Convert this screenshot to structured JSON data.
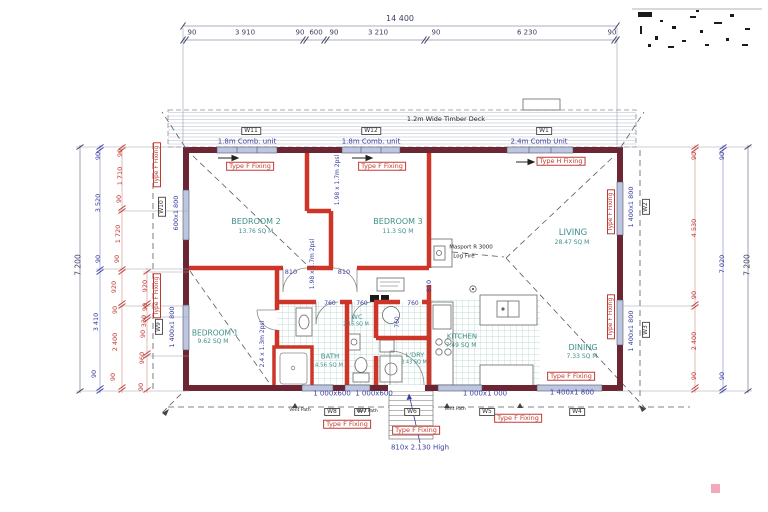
{
  "colors": {
    "exterior_wall": "#6B2533",
    "interior_wall": "#CC3527",
    "window_fill": "#BDC5E4",
    "dim_blue": "#3a3f9e",
    "dim_red": "#c23b33",
    "room_text": "#3e8f8a",
    "tile_line": "#aed2ca"
  },
  "annotations": {
    "top_dimension_chain": [
      {
        "n": "overall-width-dim",
        "t": "14 400",
        "x": 400,
        "y": 19,
        "c": "dkb",
        "s": 8
      },
      {
        "n": "seg-dim",
        "t": "90",
        "x": 192,
        "y": 33,
        "c": "dkb"
      },
      {
        "n": "seg-dim",
        "t": "3 910",
        "x": 245,
        "y": 33,
        "c": "dkb"
      },
      {
        "n": "seg-dim",
        "t": "90",
        "x": 300,
        "y": 33,
        "c": "dkb"
      },
      {
        "n": "seg-dim",
        "t": "600",
        "x": 316,
        "y": 33,
        "c": "dkb"
      },
      {
        "n": "seg-dim",
        "t": "90",
        "x": 334,
        "y": 33,
        "c": "dkb"
      },
      {
        "n": "seg-dim",
        "t": "3 210",
        "x": 378,
        "y": 33,
        "c": "dkb"
      },
      {
        "n": "seg-dim",
        "t": "90",
        "x": 436,
        "y": 33,
        "c": "dkb"
      },
      {
        "n": "seg-dim",
        "t": "6 230",
        "x": 527,
        "y": 33,
        "c": "dkb"
      },
      {
        "n": "seg-dim",
        "t": "90",
        "x": 612,
        "y": 33,
        "c": "dkb"
      }
    ],
    "deck": [
      {
        "n": "deck-label",
        "t": "1.2m Wide Timber Deck",
        "x": 446,
        "y": 119,
        "c": "dark",
        "s": 6.5
      },
      {
        "n": "window-tag-w11",
        "t": "W11",
        "x": 251,
        "y": 131,
        "b": "tag",
        "s": 6
      },
      {
        "n": "window-tag-w12",
        "t": "W12",
        "x": 371,
        "y": 131,
        "b": "tag",
        "s": 6
      },
      {
        "n": "window-tag-w1",
        "t": "W1",
        "x": 544,
        "y": 131,
        "b": "tag",
        "s": 6
      },
      {
        "n": "comb-unit-label",
        "t": "1.8m Comb. unit",
        "x": 247,
        "y": 142,
        "c": "blue",
        "s": 7
      },
      {
        "n": "comb-unit-label",
        "t": "1.8m Comb. unit",
        "x": 371,
        "y": 142,
        "c": "blue",
        "s": 7
      },
      {
        "n": "comb-unit-label",
        "t": "2.4m Comb Unit",
        "x": 539,
        "y": 142,
        "c": "blue",
        "s": 7
      }
    ],
    "fixing_labels": [
      {
        "n": "fixing-label",
        "t": "Type F Fixing",
        "x": 250,
        "y": 166,
        "b": "fix",
        "s": 6.5
      },
      {
        "n": "fixing-label",
        "t": "Type F Fixing",
        "x": 382,
        "y": 166,
        "b": "fix",
        "s": 6.5
      },
      {
        "n": "fixing-label",
        "t": "Type H Fixing",
        "x": 561,
        "y": 161,
        "b": "fix",
        "s": 6.5
      },
      {
        "n": "fixing-label",
        "t": "Type F Fixing",
        "x": 611,
        "y": 212,
        "b": "fix",
        "r": 1,
        "s": 6
      },
      {
        "n": "fixing-label",
        "t": "Type F Fixing",
        "x": 611,
        "y": 317,
        "b": "fix",
        "r": 1,
        "s": 6
      },
      {
        "n": "fixing-label",
        "t": "Type F Fixing",
        "x": 157,
        "y": 165,
        "b": "fix",
        "r": 1,
        "s": 6
      },
      {
        "n": "fixing-label",
        "t": "Type F Fixing",
        "x": 157,
        "y": 296,
        "b": "fix",
        "r": 1,
        "s": 6
      },
      {
        "n": "fixing-label",
        "t": "Type F Fixing",
        "x": 571,
        "y": 376,
        "b": "fix",
        "s": 6.5
      },
      {
        "n": "fixing-label",
        "t": "Type F Fixing",
        "x": 347,
        "y": 424,
        "b": "fix",
        "s": 6.5
      },
      {
        "n": "fixing-label",
        "t": "Type F Fixing",
        "x": 416,
        "y": 430,
        "b": "fix",
        "s": 6.5
      },
      {
        "n": "fixing-label",
        "t": "Type F Fixing",
        "x": 518,
        "y": 418,
        "b": "fix",
        "s": 6.5
      }
    ],
    "rooms": [
      {
        "n": "room-name-bedroom2",
        "t": "BEDROOM 2",
        "x": 256,
        "y": 222,
        "c": "teal",
        "s": 8
      },
      {
        "n": "room-area-bedroom2",
        "t": "13.76 SQ M",
        "x": 256,
        "y": 232,
        "c": "teal",
        "s": 6
      },
      {
        "n": "room-name-bedroom3",
        "t": "BEDROOM 3",
        "x": 398,
        "y": 222,
        "c": "teal",
        "s": 8
      },
      {
        "n": "room-area-bedroom3",
        "t": "11.3 SQ M",
        "x": 398,
        "y": 232,
        "c": "teal",
        "s": 6
      },
      {
        "n": "room-name-living",
        "t": "LIVING",
        "x": 573,
        "y": 233,
        "c": "teal",
        "s": 8.5
      },
      {
        "n": "room-area-living",
        "t": "28.47 SQ M",
        "x": 572,
        "y": 243,
        "c": "teal",
        "s": 6
      },
      {
        "n": "room-name-bedroom1",
        "t": "BEDROOM 1",
        "x": 215,
        "y": 333,
        "c": "teal",
        "s": 7.5
      },
      {
        "n": "room-area-bedroom1",
        "t": "9.62 SQ M",
        "x": 213,
        "y": 342,
        "c": "teal",
        "s": 6
      },
      {
        "n": "room-name-bath",
        "t": "BATH",
        "x": 330,
        "y": 357,
        "c": "teal",
        "s": 7
      },
      {
        "n": "room-area-bath",
        "t": "4.56 SQ M",
        "x": 329,
        "y": 366,
        "c": "teal",
        "s": 5.5
      },
      {
        "n": "room-name-wc",
        "t": "WC",
        "x": 357,
        "y": 317,
        "c": "teal",
        "s": 6.5
      },
      {
        "n": "room-area-wc",
        "t": "2.16 SQ M",
        "x": 356,
        "y": 325,
        "c": "teal",
        "s": 5
      },
      {
        "n": "room-name-ldry",
        "t": "L'DRY",
        "x": 415,
        "y": 355,
        "c": "teal",
        "s": 6.5
      },
      {
        "n": "room-area-ldry",
        "t": "3.43 SQ M",
        "x": 414,
        "y": 363,
        "c": "teal",
        "s": 5
      },
      {
        "n": "room-name-kitchen",
        "t": "KITCHEN",
        "x": 462,
        "y": 337,
        "c": "teal",
        "s": 7
      },
      {
        "n": "room-area-kitchen",
        "t": "7.49 SQ M",
        "x": 461,
        "y": 346,
        "c": "teal",
        "s": 6
      },
      {
        "n": "room-name-dining",
        "t": "DINING",
        "x": 583,
        "y": 348,
        "c": "teal",
        "s": 8
      },
      {
        "n": "room-area-dining",
        "t": "7.33 SQ M",
        "x": 582,
        "y": 357,
        "c": "teal",
        "s": 6
      }
    ],
    "fireplace_note": [
      {
        "n": "fireplace-note-line1",
        "t": "Masport R 3000",
        "x": 471,
        "y": 248,
        "c": "dark",
        "s": 5.5
      },
      {
        "n": "fireplace-note-line2",
        "t": "Log Fire",
        "x": 464,
        "y": 257,
        "c": "dark",
        "s": 5.5
      }
    ],
    "opening_dims": [
      {
        "n": "window-dim-w10",
        "t": "600x1 800",
        "x": 176,
        "y": 213,
        "c": "blue",
        "r": 1,
        "s": 6.5
      },
      {
        "n": "window-dim-w9",
        "t": "1 400x1 800",
        "x": 172,
        "y": 327,
        "c": "blue",
        "r": 1,
        "s": 6.5
      },
      {
        "n": "window-dim-w2",
        "t": "1 400x1 800",
        "x": 631,
        "y": 207,
        "c": "blue",
        "r": 1,
        "s": 6.5
      },
      {
        "n": "window-dim-w3",
        "t": "1 400x1 800",
        "x": 631,
        "y": 331,
        "c": "blue",
        "r": 1,
        "s": 6.5
      },
      {
        "n": "window-tag-w2",
        "t": "W2",
        "x": 646,
        "y": 207,
        "b": "tag",
        "r": 1,
        "s": 6
      },
      {
        "n": "window-tag-w3",
        "t": "W3",
        "x": 646,
        "y": 330,
        "b": "tag",
        "r": 1,
        "s": 6
      },
      {
        "n": "window-tag-w10",
        "t": "W10",
        "x": 162,
        "y": 207,
        "b": "tag",
        "r": 1,
        "s": 6
      },
      {
        "n": "window-tag-w9",
        "t": "W9",
        "x": 159,
        "y": 327,
        "b": "tag",
        "r": 1,
        "s": 6
      },
      {
        "n": "slider-dim",
        "t": "1.98 x 1.7m 2psl",
        "x": 338,
        "y": 180,
        "c": "blue",
        "r": 1,
        "s": 6
      },
      {
        "n": "slider-dim",
        "t": "1.98 x 1.7m 2psl",
        "x": 313,
        "y": 264,
        "c": "blue",
        "r": 1,
        "s": 6
      },
      {
        "n": "slider-dim",
        "t": "2.4 x 1.3m 2psl",
        "x": 263,
        "y": 344,
        "c": "blue",
        "r": 1,
        "s": 6
      },
      {
        "n": "door-dim",
        "t": "810",
        "x": 291,
        "y": 272,
        "c": "blue",
        "s": 6.5
      },
      {
        "n": "door-dim",
        "t": "810",
        "x": 344,
        "y": 272,
        "c": "blue",
        "s": 6.5
      },
      {
        "n": "door-dim",
        "t": "810",
        "x": 429,
        "y": 286,
        "c": "blue",
        "r": 1,
        "s": 6.5
      },
      {
        "n": "door-dim",
        "t": "760",
        "x": 330,
        "y": 304,
        "c": "blue",
        "s": 6
      },
      {
        "n": "door-dim",
        "t": "760",
        "x": 362,
        "y": 304,
        "c": "blue",
        "s": 6
      },
      {
        "n": "door-dim",
        "t": "760",
        "x": 413,
        "y": 304,
        "c": "blue",
        "s": 6
      },
      {
        "n": "door-dim",
        "t": "760",
        "x": 398,
        "y": 322,
        "c": "blue",
        "r": 1,
        "s": 6
      }
    ],
    "bottom_dims": [
      {
        "n": "window-dim-w8",
        "t": "1 000x600",
        "x": 332,
        "y": 394,
        "c": "blue",
        "s": 7
      },
      {
        "n": "window-dim-w7",
        "t": "1 000x600",
        "x": 374,
        "y": 394,
        "c": "blue",
        "s": 7
      },
      {
        "n": "window-dim-w5",
        "t": "1 000x1 000",
        "x": 485,
        "y": 394,
        "c": "blue",
        "s": 7
      },
      {
        "n": "window-dim-w4",
        "t": "1 400x1 800",
        "x": 572,
        "y": 393,
        "c": "blue",
        "s": 7
      },
      {
        "n": "door-height-note",
        "t": "810x 2.130 High",
        "x": 420,
        "y": 448,
        "c": "blue",
        "s": 7
      },
      {
        "n": "window-tag-w8",
        "t": "W8",
        "x": 332,
        "y": 412,
        "b": "tag",
        "s": 6
      },
      {
        "n": "window-tag-w7",
        "t": "W7",
        "x": 362,
        "y": 412,
        "b": "tag",
        "s": 6
      },
      {
        "n": "window-tag-w6",
        "t": "W6",
        "x": 412,
        "y": 412,
        "b": "tag",
        "s": 6
      },
      {
        "n": "window-tag-w5",
        "t": "W5",
        "x": 487,
        "y": 412,
        "b": "tag",
        "s": 6
      },
      {
        "n": "window-tag-w4",
        "t": "W4",
        "x": 577,
        "y": 412,
        "b": "tag",
        "s": 6
      },
      {
        "n": "vent-path-label",
        "t": "Vent Path",
        "x": 300,
        "y": 411,
        "c": "dark",
        "s": 4.5
      },
      {
        "n": "vent-path-label",
        "t": "Vent Path",
        "x": 367,
        "y": 412,
        "c": "dark",
        "s": 4.5
      },
      {
        "n": "vent-path-label",
        "t": "Vent Path",
        "x": 455,
        "y": 410,
        "c": "dark",
        "s": 4.5
      }
    ],
    "left_dims": [
      {
        "n": "left-overall-dim",
        "t": "7 200",
        "x": 78,
        "y": 265,
        "c": "dkb",
        "r": 1,
        "s": 7.5
      },
      {
        "n": "left-dim",
        "t": "90",
        "x": 98,
        "y": 156,
        "c": "blue",
        "r": 1,
        "s": 6.5
      },
      {
        "n": "left-dim",
        "t": "3 520",
        "x": 98,
        "y": 203,
        "c": "blue",
        "r": 1,
        "s": 6.5
      },
      {
        "n": "left-dim",
        "t": "90",
        "x": 98,
        "y": 259,
        "c": "blue",
        "r": 1,
        "s": 6.5
      },
      {
        "n": "left-dim",
        "t": "3 410",
        "x": 96,
        "y": 322,
        "c": "blue",
        "r": 1,
        "s": 6.5
      },
      {
        "n": "left-dim",
        "t": "90",
        "x": 94,
        "y": 374,
        "c": "blue",
        "r": 1,
        "s": 6.5
      },
      {
        "n": "left-dim",
        "t": "90",
        "x": 120,
        "y": 153,
        "c": "red",
        "r": 1,
        "s": 6.5
      },
      {
        "n": "left-dim",
        "t": "1 710",
        "x": 120,
        "y": 176,
        "c": "red",
        "r": 1,
        "s": 6.5
      },
      {
        "n": "left-dim",
        "t": "90",
        "x": 119,
        "y": 199,
        "c": "red",
        "r": 1,
        "s": 6.5
      },
      {
        "n": "left-dim",
        "t": "1 720",
        "x": 118,
        "y": 234,
        "c": "red",
        "r": 1,
        "s": 6.5
      },
      {
        "n": "left-dim",
        "t": "90",
        "x": 117,
        "y": 259,
        "c": "red",
        "r": 1,
        "s": 6.5
      },
      {
        "n": "left-dim",
        "t": "920",
        "x": 114,
        "y": 287,
        "c": "red",
        "r": 1,
        "s": 6.5
      },
      {
        "n": "left-dim",
        "t": "90",
        "x": 115,
        "y": 310,
        "c": "red",
        "r": 1,
        "s": 6.5
      },
      {
        "n": "left-dim",
        "t": "2 400",
        "x": 115,
        "y": 342,
        "c": "red",
        "r": 1,
        "s": 6.5
      },
      {
        "n": "left-dim",
        "t": "90",
        "x": 113,
        "y": 377,
        "c": "red",
        "r": 1,
        "s": 6.5
      },
      {
        "n": "left-dim",
        "t": "920",
        "x": 145,
        "y": 286,
        "c": "red",
        "r": 1,
        "s": 6.5
      },
      {
        "n": "left-dim",
        "t": "90",
        "x": 145,
        "y": 307,
        "c": "red",
        "r": 1,
        "s": 6.5
      },
      {
        "n": "left-dim",
        "t": "330",
        "x": 144,
        "y": 321,
        "c": "red",
        "r": 1,
        "s": 6.5
      },
      {
        "n": "left-dim",
        "t": "90",
        "x": 143,
        "y": 334,
        "c": "red",
        "r": 1,
        "s": 6.5
      },
      {
        "n": "left-dim",
        "t": "960",
        "x": 142,
        "y": 358,
        "c": "red",
        "r": 1,
        "s": 6.5
      },
      {
        "n": "left-dim",
        "t": "90",
        "x": 141,
        "y": 387,
        "c": "red",
        "r": 1,
        "s": 6.5
      }
    ],
    "right_dims": [
      {
        "n": "right-dim",
        "t": "90",
        "x": 694,
        "y": 156,
        "c": "red",
        "r": 1,
        "s": 6.5
      },
      {
        "n": "right-dim",
        "t": "4 530",
        "x": 694,
        "y": 228,
        "c": "red",
        "r": 1,
        "s": 6.5
      },
      {
        "n": "right-dim",
        "t": "90",
        "x": 694,
        "y": 295,
        "c": "red",
        "r": 1,
        "s": 6.5
      },
      {
        "n": "right-dim",
        "t": "2 400",
        "x": 694,
        "y": 341,
        "c": "red",
        "r": 1,
        "s": 6.5
      },
      {
        "n": "right-dim",
        "t": "90",
        "x": 694,
        "y": 376,
        "c": "red",
        "r": 1,
        "s": 6.5
      },
      {
        "n": "right-dim",
        "t": "90",
        "x": 722,
        "y": 156,
        "c": "blue",
        "r": 1,
        "s": 6.5
      },
      {
        "n": "right-dim",
        "t": "7 020",
        "x": 722,
        "y": 264,
        "c": "blue",
        "r": 1,
        "s": 6.5
      },
      {
        "n": "right-dim",
        "t": "90",
        "x": 722,
        "y": 376,
        "c": "blue",
        "r": 1,
        "s": 6.5
      },
      {
        "n": "right-overall-dim",
        "t": "7 200",
        "x": 747,
        "y": 265,
        "c": "dkb",
        "r": 1,
        "s": 7.5
      }
    ]
  }
}
